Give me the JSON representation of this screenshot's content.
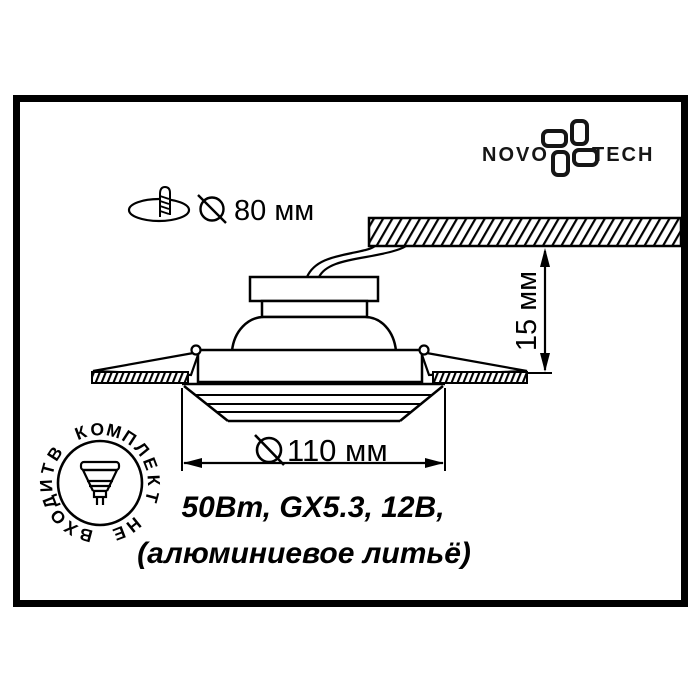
{
  "logo": {
    "left": "NOVO",
    "right": "TECH"
  },
  "cutout_dimension": {
    "label": "80 мм"
  },
  "depth_dimension": {
    "label": "15 мм"
  },
  "diameter_dimension": {
    "label": "110 мм"
  },
  "caption": {
    "line1": "50Вт, GX5.3, 12В,",
    "line2": "(алюминиевое литьё)"
  },
  "badge": {
    "text": "В КОМПЛЕКТ НЕ ВХОДИТ"
  },
  "icons": {
    "pinwheel-icon": "four rounded petals pinwheel (Novotech mark)",
    "cutout-hole-icon": "ellipse hole with mounting screw",
    "screw-icon": "threaded screw",
    "diameter-symbol-icon": "circle with diagonal slash",
    "mr16-lamp-icon": "GX5.3 halogen lamp, face up, two pins"
  },
  "colors": {
    "ink": "#000000",
    "background": "#ffffff"
  }
}
